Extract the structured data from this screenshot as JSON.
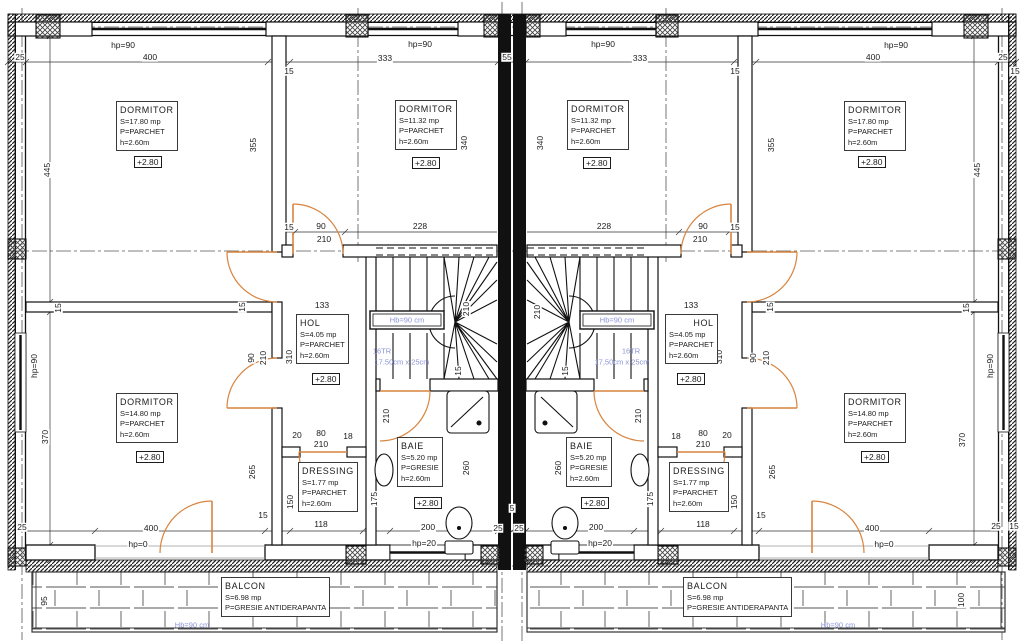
{
  "title": "Floor plan - etaj (+2.80)",
  "colors": {
    "wall": "#1a1a1a",
    "door": "#d8843f",
    "annotation": "#8b93d6",
    "dim": "#1c1c1c",
    "bg": "#ffffff"
  },
  "rooms": {
    "left": {
      "dormitor_top": {
        "name": "DORMITOR",
        "area": "S=17.80 mp",
        "floor": "P=PARCHET",
        "height": "h=2.60m",
        "level": "+2.80"
      },
      "dormitor_mid": {
        "name": "DORMITOR",
        "area": "S=11.32 mp",
        "floor": "P=PARCHET",
        "height": "h=2.60m",
        "level": "+2.80"
      },
      "hol": {
        "name": "HOL",
        "area": "S=4.05 mp",
        "floor": "P=PARCHET",
        "height": "h=2.60m",
        "level": "+2.80"
      },
      "dormitor_bottom": {
        "name": "DORMITOR",
        "area": "S=14.80 mp",
        "floor": "P=PARCHET",
        "height": "h=2.60m",
        "level": "+2.80"
      },
      "dressing": {
        "name": "DRESSING",
        "area": "S=1.77 mp",
        "floor": "P=PARCHET",
        "height": "h=2.60m"
      },
      "baie": {
        "name": "BAIE",
        "area": "S=5.20 mp",
        "floor": "P=GRESIE",
        "height": "h=2.60m",
        "level": "+2.80"
      },
      "balcon": {
        "name": "BALCON",
        "area": "S=6.98 mp",
        "floor": "P=GRESIE ANTIDERAPANTA"
      }
    },
    "right": {
      "dormitor_top": {
        "name": "DORMITOR",
        "area": "S=17.80 mp",
        "floor": "P=PARCHET",
        "height": "h=2.60m",
        "level": "+2.80"
      },
      "dormitor_mid": {
        "name": "DORMITOR",
        "area": "S=11.32 mp",
        "floor": "P=PARCHET",
        "height": "h=2.60m",
        "level": "+2.80"
      },
      "hol": {
        "name": "HOL",
        "area": "S=4.05 mp",
        "floor": "P=PARCHET",
        "height": "h=2.60m",
        "level": "+2.80"
      },
      "dormitor_bottom": {
        "name": "DORMITOR",
        "area": "S=14.80 mp",
        "floor": "P=PARCHET",
        "height": "h=2.60m",
        "level": "+2.80"
      },
      "dressing": {
        "name": "DRESSING",
        "area": "S=1.77 mp",
        "floor": "P=PARCHET",
        "height": "h=2.60m"
      },
      "baie": {
        "name": "BAIE",
        "area": "S=5.20 mp",
        "floor": "P=GRESIE",
        "height": "h=2.60m",
        "level": "+2.80"
      },
      "balcon": {
        "name": "BALCON",
        "area": "S=6.98 mp",
        "floor": "P=GRESIE ANTIDERAPANTA"
      }
    }
  },
  "annotations": {
    "stair_rail_left": "Hb=90 cm",
    "stair_rail_right": "Hb=90 cm",
    "treads_left": "16TR",
    "tread_size_left": "17.50cm x 25cm",
    "treads_right": "16TR",
    "tread_size_right": "17,50cm x 25cm",
    "balcony_rail_left": "Hb=90 cm",
    "balcony_rail_right": "Hb=90 cm"
  },
  "dims": {
    "top": [
      "25",
      "hp=90",
      "400",
      "15",
      "hp=90",
      "333",
      "55",
      "333",
      "hp=90",
      "15",
      "400",
      "hp=90",
      "25",
      "15"
    ],
    "left": [
      "445",
      "15",
      "hp=90",
      "370",
      "25",
      "95"
    ],
    "right": [
      "445",
      "15",
      "hp=90",
      "370",
      "25",
      "15",
      "100"
    ],
    "mid": [
      "355",
      "340",
      "340",
      "355",
      "15",
      "90",
      "210",
      "228",
      "228",
      "90",
      "210",
      "15"
    ],
    "hol": [
      "133",
      "310",
      "90",
      "210",
      "15",
      "133",
      "310",
      "90",
      "210",
      "15"
    ],
    "stairs": [
      "210",
      "210",
      "15",
      "15"
    ],
    "baie": [
      "210",
      "260",
      "200",
      "hp=20",
      "260",
      "210",
      "200",
      "hp=20"
    ],
    "dressing": [
      "20",
      "80",
      "18",
      "210",
      "150",
      "118",
      "15",
      "175",
      "18",
      "80",
      "20",
      "210",
      "150",
      "118",
      "15",
      "175"
    ],
    "bottom": [
      "400",
      "hp=0",
      "25",
      "25",
      "5",
      "400",
      "hp=0",
      "265",
      "265"
    ]
  }
}
